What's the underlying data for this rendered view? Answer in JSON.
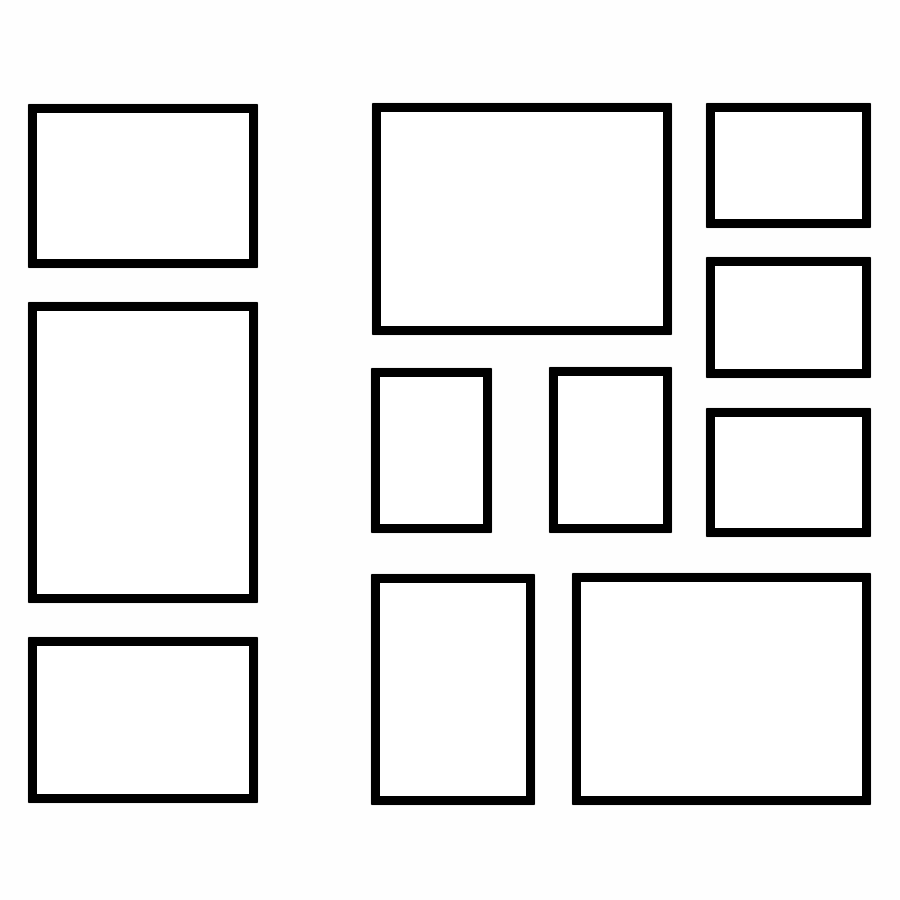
{
  "canvas": {
    "width": 900,
    "height": 900,
    "background_color": "#fefefe",
    "description": "Gallery wall layout template of eleven empty rectangular picture frames"
  },
  "frame_style": {
    "border_color": "#000000",
    "border_width_px": 9,
    "fill_color": "#ffffff"
  },
  "frames": [
    {
      "name": "frame-left-top",
      "orientation": "landscape",
      "x": 28,
      "y": 104,
      "w": 230,
      "h": 164
    },
    {
      "name": "frame-left-middle",
      "orientation": "portrait",
      "x": 28,
      "y": 302,
      "w": 230,
      "h": 301
    },
    {
      "name": "frame-left-bottom",
      "orientation": "landscape",
      "x": 28,
      "y": 637,
      "w": 230,
      "h": 166
    },
    {
      "name": "frame-center-top",
      "orientation": "landscape",
      "x": 372,
      "y": 103,
      "w": 300,
      "h": 232
    },
    {
      "name": "frame-center-small-left",
      "orientation": "portrait",
      "x": 371,
      "y": 368,
      "w": 121,
      "h": 165
    },
    {
      "name": "frame-center-small-right",
      "orientation": "portrait",
      "x": 549,
      "y": 367,
      "w": 123,
      "h": 166
    },
    {
      "name": "frame-bottom-center",
      "orientation": "portrait",
      "x": 371,
      "y": 574,
      "w": 164,
      "h": 231
    },
    {
      "name": "frame-bottom-right",
      "orientation": "landscape",
      "x": 572,
      "y": 573,
      "w": 299,
      "h": 232
    },
    {
      "name": "frame-right-top",
      "orientation": "landscape",
      "x": 706,
      "y": 103,
      "w": 165,
      "h": 125
    },
    {
      "name": "frame-right-middle",
      "orientation": "landscape",
      "x": 706,
      "y": 257,
      "w": 165,
      "h": 121
    },
    {
      "name": "frame-right-bottom",
      "orientation": "landscape",
      "x": 706,
      "y": 408,
      "w": 165,
      "h": 129
    }
  ]
}
